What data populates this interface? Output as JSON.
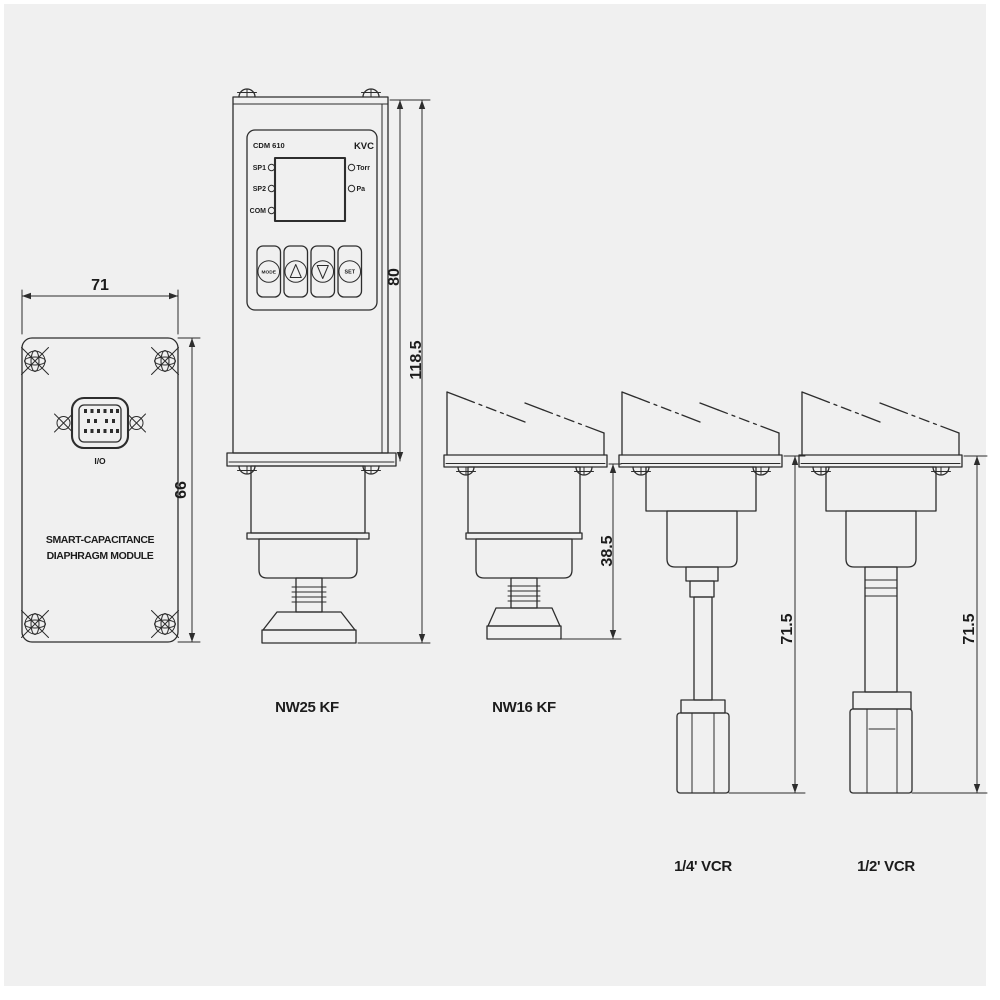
{
  "background": "#f0f0f0",
  "ink": "#2d2d2d",
  "rear_module": {
    "dim_width": "71",
    "dim_height": "66",
    "connector_label": "I/O",
    "caption_line1": "SMART-CAPACITANCE",
    "caption_line2": "DIAPHRAGM MODULE"
  },
  "controller": {
    "model": "CDM 610",
    "brand": "KVC",
    "led_left": [
      "SP1",
      "SP2",
      "COM"
    ],
    "led_right": [
      "Torr",
      "Pa"
    ],
    "button_mode": "MODE",
    "button_set": "SET",
    "dim_body_height": "80",
    "dim_total_height": "118.5",
    "fitting_label": "NW25 KF"
  },
  "nw16": {
    "fitting_label": "NW16 KF",
    "dim_height": "38.5"
  },
  "vcr_quarter": {
    "fitting_label": "1/4' VCR",
    "dim_height": "71.5"
  },
  "vcr_half": {
    "fitting_label": "1/2' VCR",
    "dim_height": "71.5"
  },
  "icons": {
    "screw_corner": "rosette-screw",
    "screw_dome": "slotted-dome-screw",
    "up_button": "triangle-up",
    "down_button": "triangle-down"
  }
}
